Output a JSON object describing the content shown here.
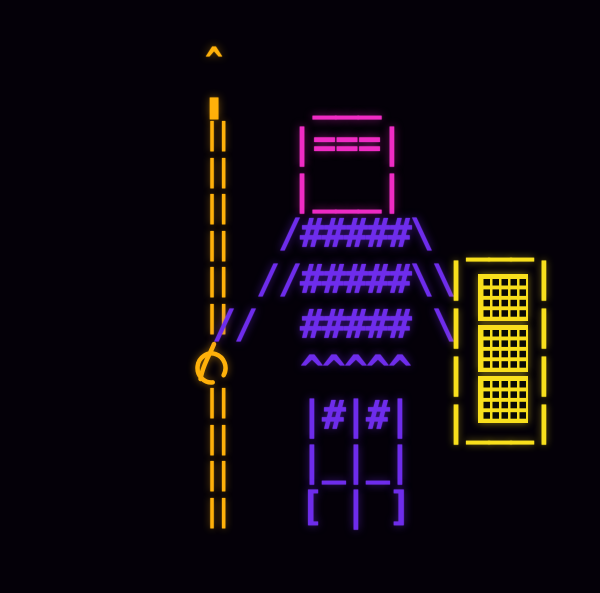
{
  "scene": {
    "description": "Neon ASCII-art warrior holding a tall spear, wearing a visored helmet and crosshatched armor, with a studded tower shield at its right side",
    "background": "#040008",
    "width": 600,
    "height": 593
  },
  "palette": {
    "spear_orange": "#FFB10A",
    "helmet_pink": "#F02BC4",
    "armor_violet": "#6E2CEC",
    "shield_yellow": "#F8DF1C"
  },
  "spear": {
    "tip_art": "^\n▮",
    "upper_shaft_art": "||\n||\n||\n||\n||\n||",
    "grip": "の",
    "lower_shaft_art": "||\n||\n||\n||"
  },
  "helmet": {
    "crown_art": " ___",
    "face_art": "|===|\n|___|"
  },
  "armor": {
    "body_art": "   /#####\\\n  //#####\\\\\n//  ##### \\\n    ^^^^^\n    |#|#|\n    |_|_|\n    [ | ]"
  },
  "shield": {
    "top_art": " ___",
    "frame_art": "|   |\n|   |\n|   |\n|___|",
    "emblem_count": 3
  }
}
